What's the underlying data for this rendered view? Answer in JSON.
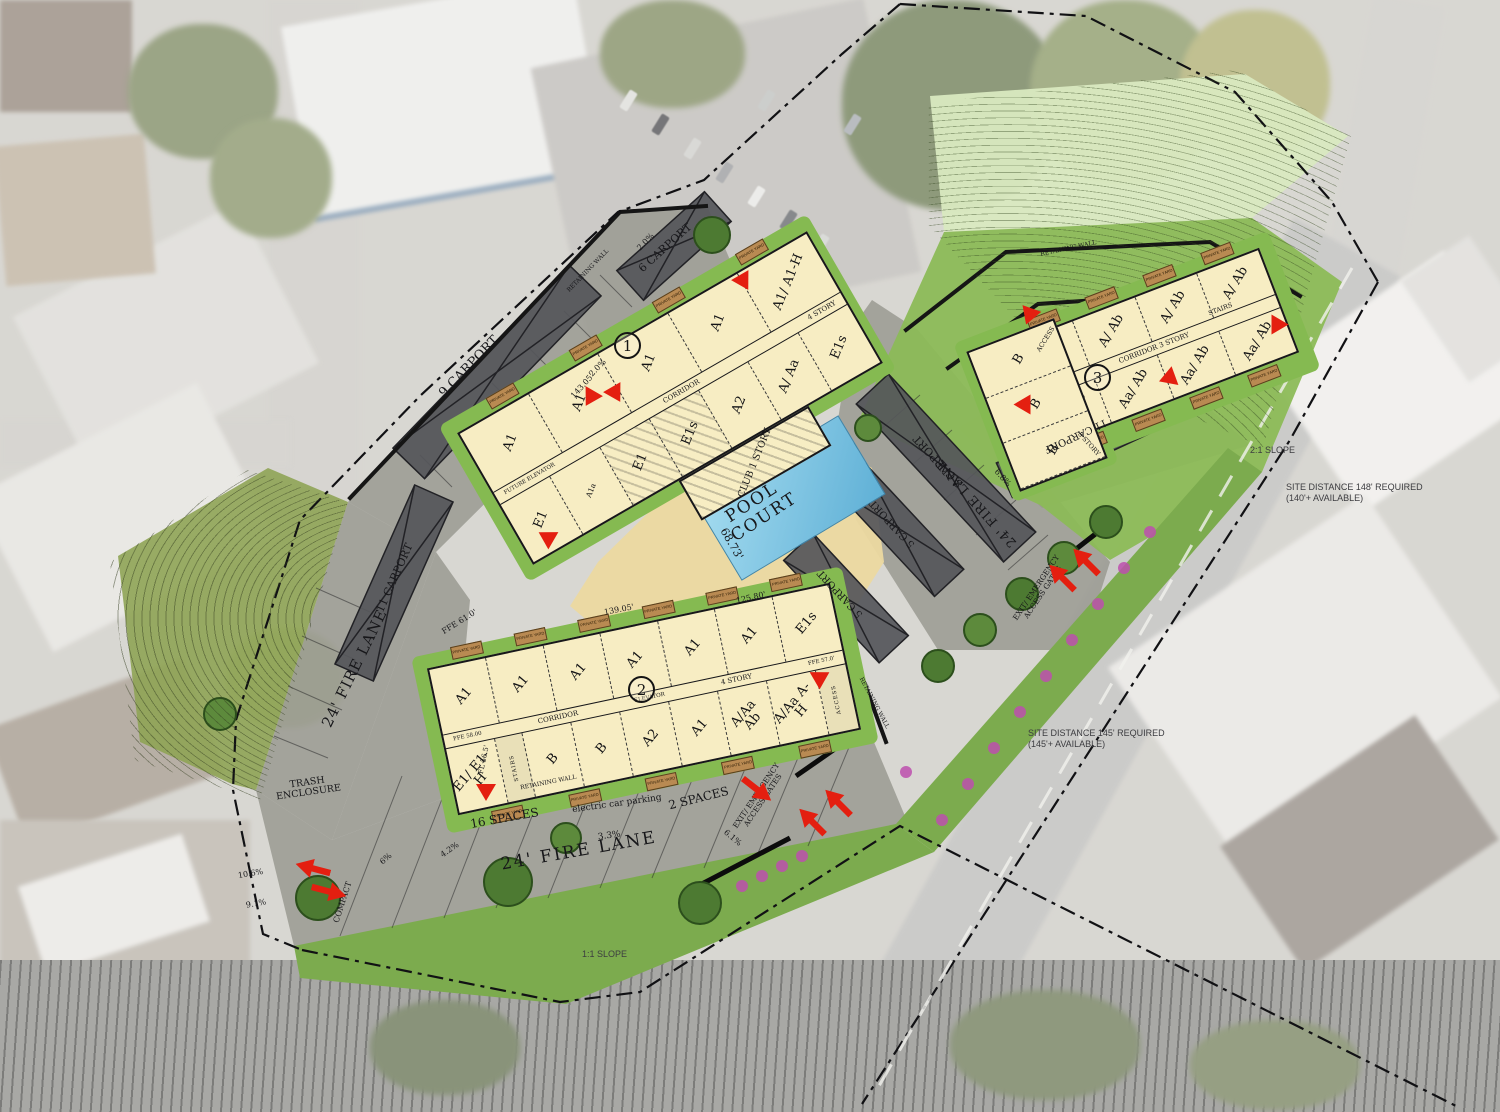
{
  "plan": {
    "buildings": {
      "b1": {
        "number": "1",
        "story": "4 STORY",
        "corridor": "CORRIDOR",
        "elevator": "FUTURE ELEVATOR",
        "club": "CLUB 1 STORY",
        "units_top": [
          {
            "label": "A1"
          },
          {
            "label": "A1"
          },
          {
            "label": "A1"
          },
          {
            "label": "A1"
          },
          {
            "label": "A1/ A1-H"
          }
        ],
        "units_bottom": [
          {
            "label": "E1"
          },
          {
            "label": "A1a",
            "cls": "small"
          },
          {
            "label": "E1",
            "cls": "hatch"
          },
          {
            "label": "E1s",
            "cls": "hatch"
          },
          {
            "label": "A2"
          },
          {
            "label": "A/ Aa"
          },
          {
            "label": "E1s"
          }
        ]
      },
      "b2": {
        "number": "2",
        "story": "4 STORY",
        "corridor": "CORRIDOR",
        "elevator": "ELEVATOR",
        "ffe_left": "FFE 58.00",
        "ffe_right": "FFE 57.0'",
        "units_top": [
          {
            "label": "A1"
          },
          {
            "label": "A1"
          },
          {
            "label": "A1"
          },
          {
            "label": "A1"
          },
          {
            "label": "A1"
          },
          {
            "label": "A1"
          },
          {
            "label": "E1s"
          }
        ],
        "units_bottom": [
          {
            "label": "E1/ E1-H"
          },
          {
            "label": "STAIRS",
            "cls": "stairs"
          },
          {
            "label": "B"
          },
          {
            "label": "B"
          },
          {
            "label": "A2"
          },
          {
            "label": "A1"
          },
          {
            "label": "A/Aa Ab"
          },
          {
            "label": "A/Aa A-H"
          },
          {
            "label": "ACCESS",
            "cls": "stairs"
          }
        ]
      },
      "b3": {
        "number": "3",
        "story": "3 STORY",
        "corridor": "CORRIDOR  3 STORY",
        "stairs": "STAIRS",
        "access": "ACCESS",
        "units_top": [
          {
            "label": "A/ Ab"
          },
          {
            "label": "A/ Ab"
          },
          {
            "label": "A/ Ab"
          },
          {
            "label": "A/ Ab"
          }
        ],
        "units_bottom": [
          {
            "label": "Aa/ Ab"
          },
          {
            "label": "Aa/ Ab"
          },
          {
            "label": "Aa/ Ab"
          },
          {
            "label": "Aa/ Ab"
          }
        ],
        "units_wing": [
          {
            "label": "B"
          },
          {
            "label": "B"
          },
          {
            "label": "B"
          }
        ]
      }
    },
    "yards": {
      "b1_top": [
        "PRIVATE YARD",
        "PRIVATE YARD",
        "PRIVATE YARD",
        "PRIVATE YARD"
      ],
      "b1_bot": [
        "PRIVATE YARD",
        "PRIVATE YARD",
        "PRIVATE YARD",
        "PRIVATE YARD",
        "PRIVATE YARD"
      ],
      "b2_top": [
        "PRIVATE YARD",
        "PRIVATE YARD",
        "PRIVATE YARD",
        "PRIVATE YARD",
        "PRIVATE YARD",
        "PRIVATE YARD"
      ],
      "b2_bot": [
        "PRIVATE YARD",
        "PRIVATE YARD",
        "PRIVATE YARD",
        "PRIVATE YARD",
        "PRIVATE YARD"
      ],
      "b3_top": [
        "PRIVATE YARD",
        "PRIVATE YARD",
        "PRIVATE YARD",
        "PRIVATE YARD"
      ],
      "b3_bot": [
        "PRIVATE YARD",
        "PRIVATE YARD",
        "PRIVATE YARD",
        "PRIVATE YARD"
      ]
    },
    "pool": {
      "label": "POOL COURT",
      "dim": "68.73'"
    },
    "labels": {
      "carport_9": "9 CARPORT",
      "carport_6": "6 CARPORT",
      "carport_11_left": "11 CARPORT",
      "carport_8": "8 CARPORT",
      "carport_5_a": "5 CARPORT",
      "carport_5_b": "5 CARPORT",
      "carport_11_right": "11 CARPORT",
      "fire_lane_left": "24' FIRE LANE",
      "fire_lane_bottom": "24' FIRE LANE",
      "fire_lane_right": "24' FIRE LANE",
      "trash_enclosure": "TRASH ENCLOSURE",
      "compact": "COMPACT",
      "electric_car_parking": "electric car parking",
      "spaces_16": "16 SPACES",
      "spaces_2": "2 SPACES",
      "exit_gates_bottom": "EXIT/ EMERGENCY ACCESS GATES",
      "exit_gates_right": "EXIT/ EMERGENCY ACCESS GATES",
      "retaining_wall_1": "RETAINING WALL",
      "retaining_wall_2": "RETAINING WALL",
      "retaining_wall_3": "RETAINING WALL",
      "retaining_wall_4": "RETAINING WALL",
      "slope_2_1": "2:1 SLOPE",
      "slope_1_1": "1:1 SLOPE",
      "site_distance_right_1": "SITE DISTANCE 148' REQUIRED",
      "site_distance_right_2": "(140'+ AVAILABLE)",
      "site_distance_lower_1": "SITE DISTANCE 145' REQUIRED",
      "site_distance_lower_2": "(145'+ AVAILABLE)",
      "dim_143": "143.05'",
      "dim_139": "139.05'",
      "dim_125": "125.80'",
      "ffe_61": "FFE 61.0'",
      "fl_56": "FL 56.5'",
      "pct_2_0_a": "2.0%",
      "pct_2_0_b": "2.0%",
      "pct_3_3": "3.3%",
      "pct_4_2": "4.2%",
      "pct_6_0": "6%",
      "pct_6_1": "6.1%",
      "pct_6_8": "6.8%",
      "pct_9_1": "9.1%",
      "pct_10_6": "10.6%"
    },
    "colors": {
      "building_fill": "#f7edc3",
      "pavement": "#97978f",
      "carport": "#55565a",
      "pool_water": "#79c4e4",
      "green_dark": "#7cab4e",
      "green_mid": "#8cbb57",
      "green_pale": "#d9e9c0",
      "yard_block": "#b98a52",
      "marker_red": "#e41f10",
      "shrub_pink": "#bd4fae"
    }
  }
}
